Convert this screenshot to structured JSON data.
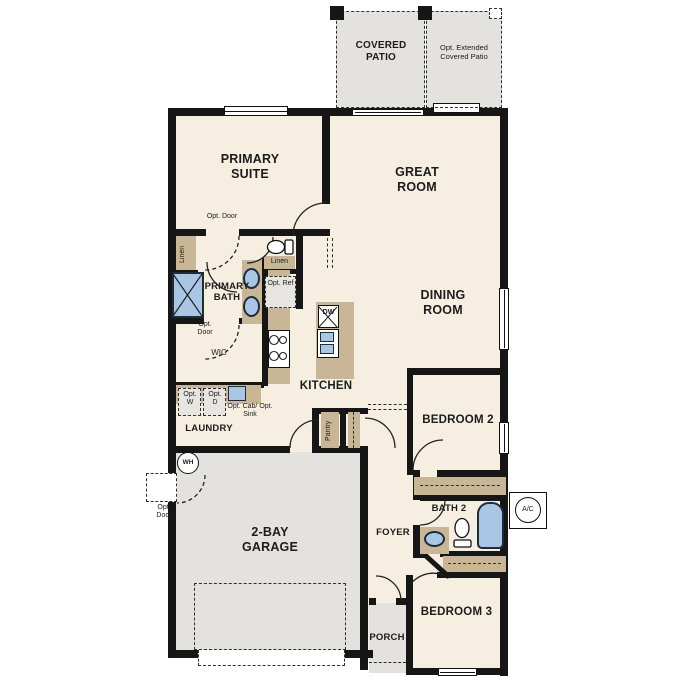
{
  "plan_type": "single-story floor plan",
  "rooms": {
    "covered_patio": "COVERED PATIO",
    "opt_extended_patio": "Opt. Extended Covered Patio",
    "primary_suite": "PRIMARY SUITE",
    "great_room": "GREAT ROOM",
    "primary_bath": "PRIMARY BATH",
    "dining_room": "DINING ROOM",
    "wic": "WIC",
    "kitchen": "KITCHEN",
    "laundry": "LAUNDRY",
    "bedroom_2": "BEDROOM 2",
    "garage": "2-BAY GARAGE",
    "foyer": "FOYER",
    "bath_2": "BATH 2",
    "bedroom_3": "BEDROOM 3",
    "porch": "PORCH"
  },
  "labels": {
    "opt_door": "Opt. Door",
    "linen": "Linen",
    "opt_ref": "Opt. Ref",
    "dishwasher": "DW",
    "opt_washer": "Opt. W",
    "opt_dryer": "Opt. D",
    "opt_cab_sink": "Opt. Cab/ Opt. Sink",
    "pantry": "Pantry",
    "water_heater": "WH",
    "ac_unit": "A/C"
  },
  "colors": {
    "floor": "#f6eee0",
    "patio_garage": "#e3e2df",
    "cabinet_tan": "#c8b697",
    "fixture_blue": "#a9c7e5",
    "wall_black": "#161616"
  }
}
